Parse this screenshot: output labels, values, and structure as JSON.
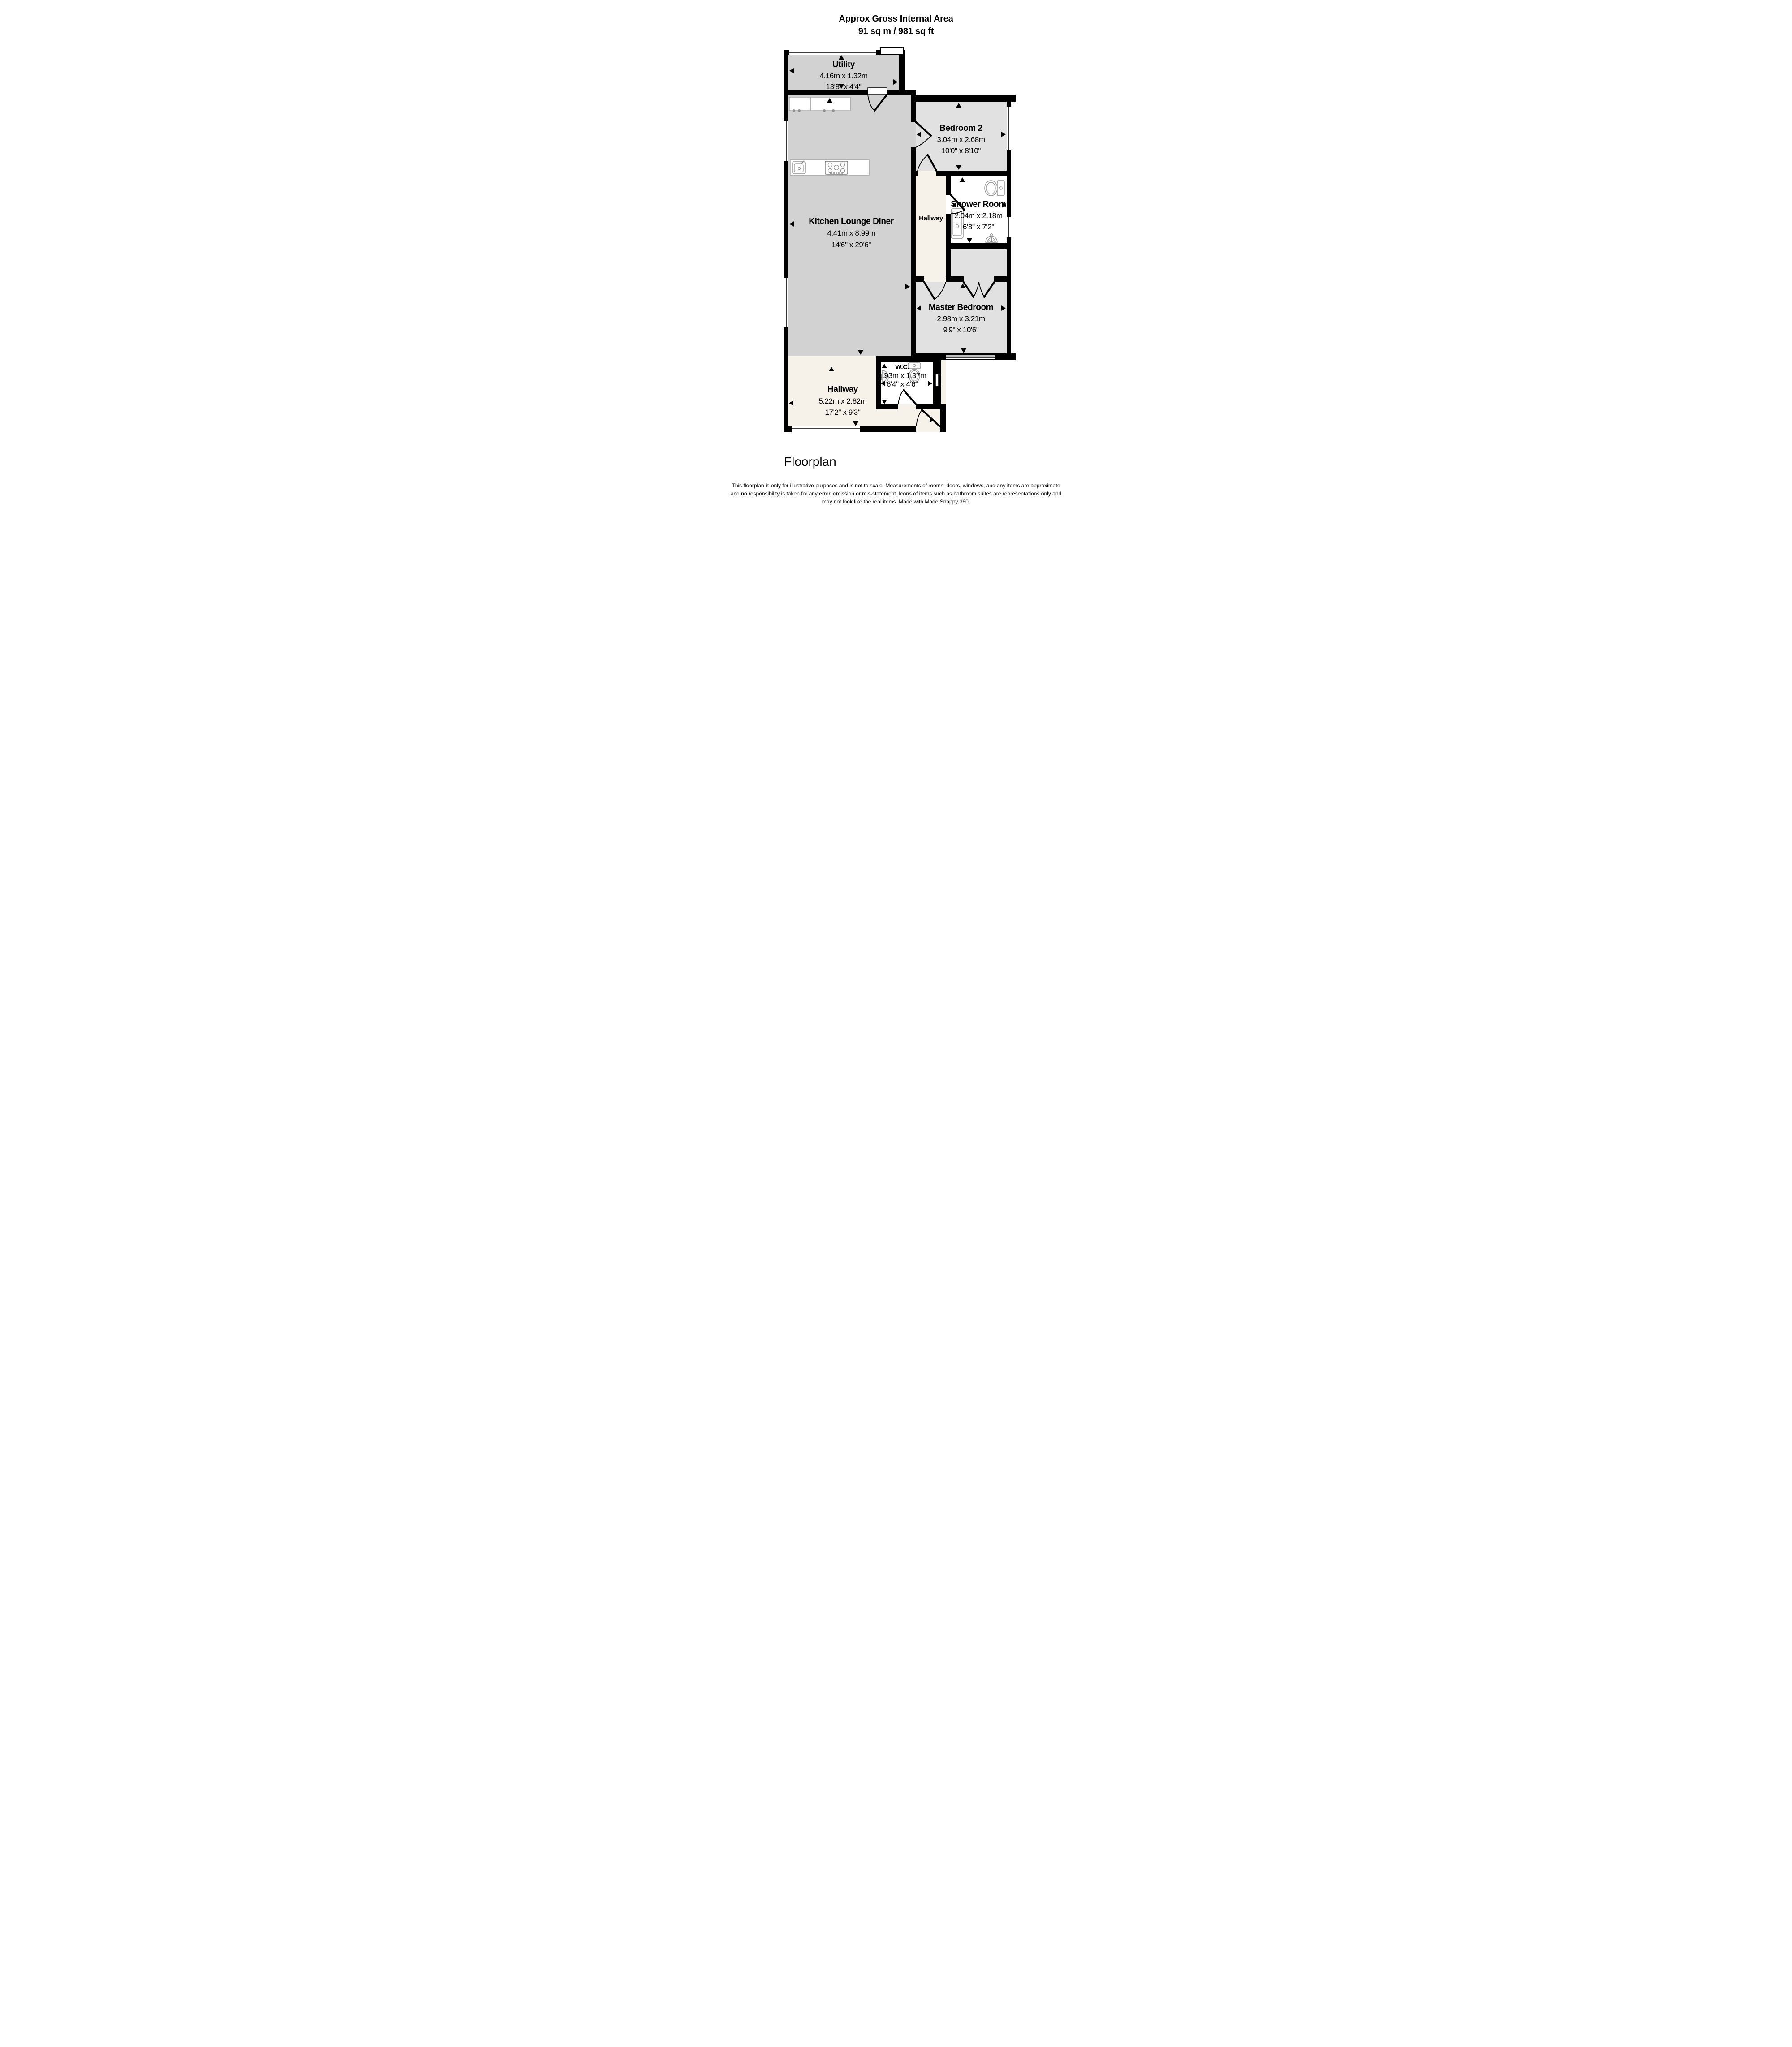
{
  "header": {
    "title": "Approx Gross Internal Area",
    "area": "91 sq m / 981 sq ft"
  },
  "rooms": [
    {
      "id": "utility",
      "name": "Utility",
      "size_metric": "4.16m x 1.32m",
      "size_imperial": "13'8\" x 4'4\""
    },
    {
      "id": "bedroom-2",
      "name": "Bedroom 2",
      "size_metric": "3.04m x 2.68m",
      "size_imperial": "10'0\" x 8'10\""
    },
    {
      "id": "kitchen-lounge-diner",
      "name": "Kitchen Lounge Diner",
      "size_metric": "4.41m x 8.99m",
      "size_imperial": "14'6\" x 29'6\""
    },
    {
      "id": "hallway-small",
      "name": "Hallway",
      "size_metric": "",
      "size_imperial": ""
    },
    {
      "id": "shower-room",
      "name": "Shower Room",
      "size_metric": "2.04m x 2.18m",
      "size_imperial": "6'8\" x 7'2\""
    },
    {
      "id": "master-bedroom",
      "name": "Master Bedroom",
      "size_metric": "2.98m x 3.21m",
      "size_imperial": "9'9\" x 10'6\""
    },
    {
      "id": "wc",
      "name": "W.C.",
      "size_metric": "1.93m x 1.37m",
      "size_imperial": "6'4\" x 4'6\""
    },
    {
      "id": "hallway",
      "name": "Hallway",
      "size_metric": "5.22m x 2.82m",
      "size_imperial": "17'2\" x 9'3\""
    }
  ],
  "caption": "Floorplan",
  "disclaimer": {
    "line1": "This floorplan is only for illustrative purposes and is not to scale. Measurements of rooms, doors, windows, and any items are approximate",
    "line2": "and no responsibility is taken for any error, omission or mis-statement. Icons of items such as bathroom suites are representations only and",
    "line3": "may not look like the real items. Made with Made Snappy 360."
  },
  "colors": {
    "wall": "#000000",
    "floor_gray": "#d2d2d2",
    "floor_bedroom_gray": "#e1e1e1",
    "floor_hallway_cream": "#f7f2e9",
    "floor_wet_room_white": "#ffffff",
    "fixture_outline": "#8f8f8f"
  }
}
